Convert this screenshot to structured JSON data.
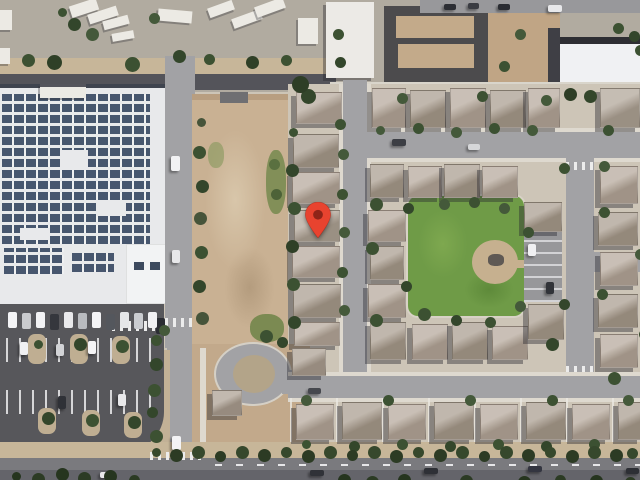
{
  "map": {
    "view": "satellite-aerial",
    "visible_text": [],
    "marker": {
      "label": "location-pin",
      "x": 318,
      "y": 215,
      "pin_color": "#e8432f",
      "pin_dot_color": "#8e2418"
    },
    "palette": {
      "base_concrete": "#cdc5b7",
      "top_pavement": "#b1aba0",
      "road_dark": "#54545a",
      "street": "#a2a2a5",
      "main_road": "#7a7a7e",
      "parking_asphalt": "#57575b",
      "warehouse_roof": "#e8e9eb",
      "solar_panel": "#47566e",
      "dirt_lot": "#c9b193",
      "dirt_south": "#c2a98b",
      "park_green": "#6f9b47",
      "playground_sand": "#c6b08f",
      "sidewalk": "#ded9cf",
      "tan_strip": "#c7b699",
      "tree_dark": "#3c5132",
      "roof_light": "#b2a496",
      "roof_dark": "#a59889"
    },
    "features": [
      "industrial-yard-north",
      "solar-roof-warehouse",
      "vacant-dirt-lot",
      "residential-neighborhood",
      "community-park",
      "playground",
      "parking-lot",
      "cul-de-sac",
      "main-road-south",
      "marked-house"
    ]
  }
}
